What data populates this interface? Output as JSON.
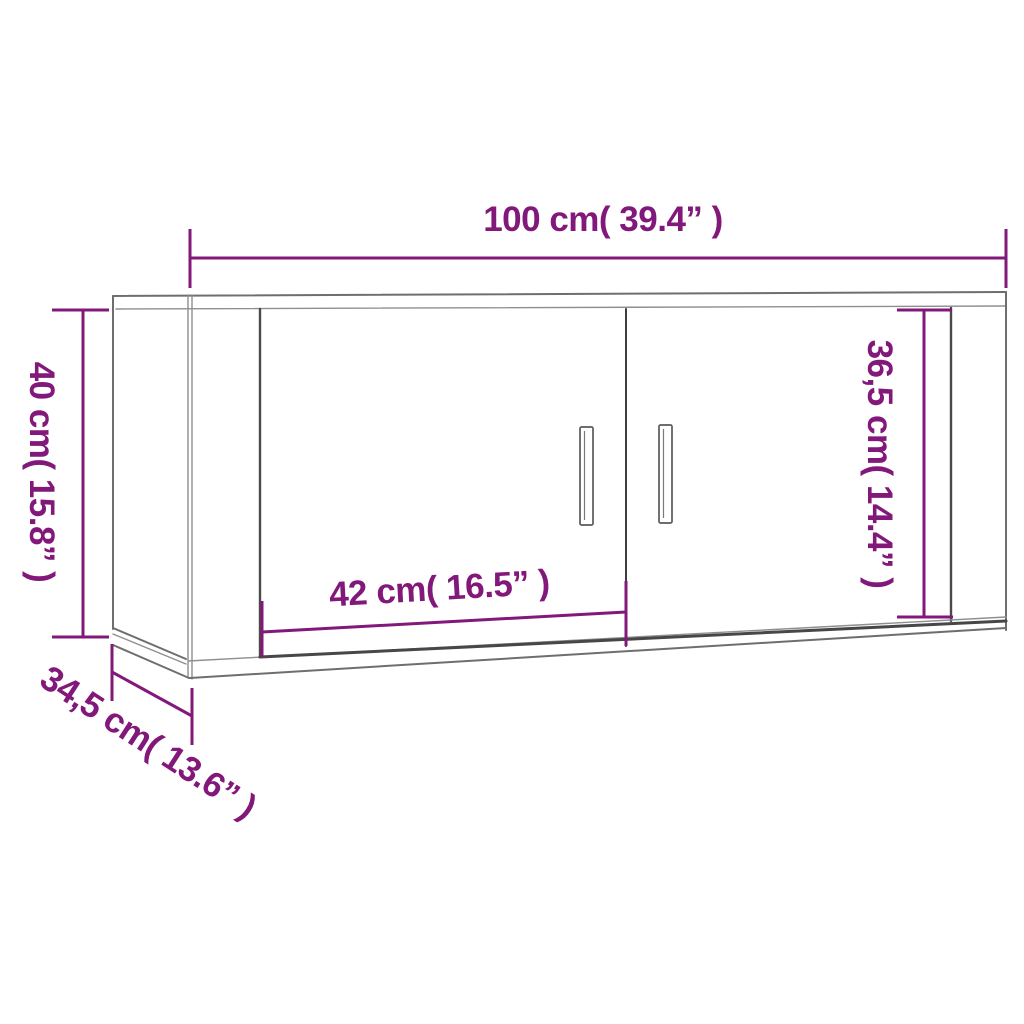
{
  "diagram_type": "furniture-dimension-drawing",
  "subject": "wall-mounted-tv-cabinet-two-doors",
  "colors": {
    "background": "#ffffff",
    "dimension": "#82187a",
    "outline_gray": "#6e6e6e",
    "outline_dark": "#4a4a4a"
  },
  "dimensions": {
    "width": {
      "label": "100 cm( 39.4” )"
    },
    "height": {
      "label": "40 cm( 15.8” )"
    },
    "door_height": {
      "label": "36,5 cm( 14.4” )"
    },
    "door_width": {
      "label": "42 cm( 16.5” )"
    },
    "depth": {
      "label": "34,5 cm( 13.6” )"
    }
  }
}
